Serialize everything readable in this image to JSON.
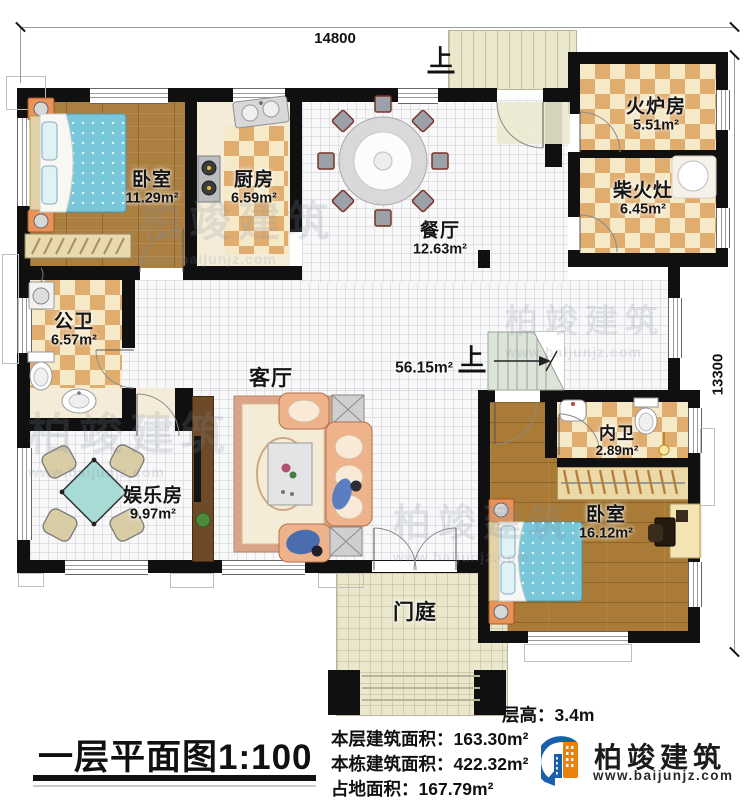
{
  "dimensions": {
    "top": "14800",
    "right": "13300"
  },
  "rooms": {
    "bedroom_tl": {
      "name": "卧室",
      "area": "11.29m²"
    },
    "kitchen": {
      "name": "厨房",
      "area": "6.59m²"
    },
    "dining": {
      "name": "餐厅",
      "area": "12.63m²"
    },
    "furnace": {
      "name": "火炉房",
      "area": "5.51m²"
    },
    "wood_stove": {
      "name": "柴火灶",
      "area": "6.45m²"
    },
    "public_bath": {
      "name": "公卫",
      "area": "6.57m²"
    },
    "living": {
      "name": "客厅",
      "area": "56.15m²"
    },
    "recreation": {
      "name": "娱乐房",
      "area": "9.97m²"
    },
    "inner_bath": {
      "name": "内卫",
      "area": "2.89m²"
    },
    "bedroom_br": {
      "name": "卧室",
      "area": "16.12m²"
    },
    "entry_porch": {
      "name": "门庭"
    }
  },
  "stairs": {
    "up_label_top": "上",
    "up_label_main": "上"
  },
  "title_block": {
    "title": "一层平面图1:100",
    "floor_height_label": "层高：",
    "floor_height_value": "3.4m",
    "info_lines": [
      {
        "label": "本层建筑面积：",
        "value": "163.30m²"
      },
      {
        "label": "本栋建筑面积：",
        "value": "422.32m²"
      },
      {
        "label": "占地面积：",
        "value": "167.79m²"
      }
    ]
  },
  "logo": {
    "brand": "柏竣建筑",
    "website": "www.baijunjz.com"
  },
  "watermark": {
    "brand": "柏竣建筑",
    "website": "www.baijunjz.com"
  },
  "colors": {
    "wall": "#101010",
    "checker_dark": "#e0ad6e",
    "checker_light": "#f6e9c8",
    "wood_floor": "#ab7f40",
    "bed_blue": "#79c7da",
    "sofa_peach": "#efb38c",
    "logo_blue": "#1a5fae",
    "logo_orange": "#e8820c"
  }
}
